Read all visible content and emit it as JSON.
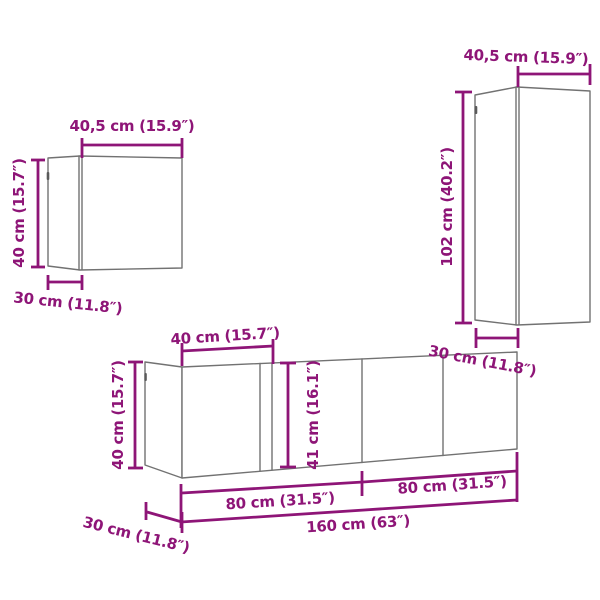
{
  "meta": {
    "accent_color": "#8E1577",
    "outline_color": "#727272",
    "background_color": "#ffffff",
    "diagram_kind": "furniture-dimension-diagram"
  },
  "cabinets": {
    "small_wall_cabinet": {
      "width_label": "40,5 cm (15.9″)",
      "height_label": "40 cm (15.7″)",
      "depth_label": "30 cm (11.8″)"
    },
    "tall_wall_cabinet": {
      "width_label": "40,5 cm (15.9″)",
      "height_label": "102 cm (40.2″)",
      "depth_label": "30 cm (11.8″)"
    },
    "row_cabinets": {
      "door_width_label": "40 cm (15.7″)",
      "height_label": "40 cm (15.7″)",
      "front_height_label": "41 cm (16.1″)",
      "left_section_label": "80 cm (31.5″)",
      "right_section_label": "80 cm (31.5″)",
      "total_width_label": "160 cm (63″)",
      "depth_label": "30 cm (11.8″)"
    }
  }
}
